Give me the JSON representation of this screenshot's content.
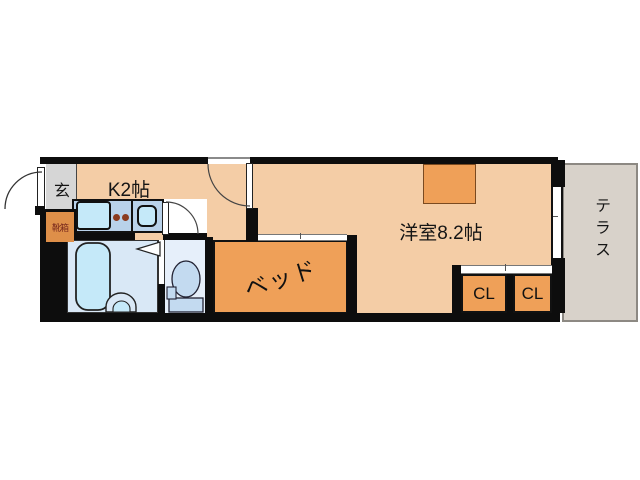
{
  "plan": {
    "labels": {
      "entrance": "玄",
      "shoe_box": "靴箱",
      "kitchen": "K2帖",
      "western_room": "洋室8.2帖",
      "bed": "ベッド",
      "closet_left": "CL",
      "closet_right": "CL",
      "terrace": "テラス"
    },
    "colors": {
      "wall": "#0d0d0d",
      "floor_peach": "#f4cda6",
      "furniture_orange": "#efa058",
      "shoebox_orange": "#de8f49",
      "shoebox_text": "#78281c",
      "counter_blue": "#b9d2ea",
      "fixture_cyan": "#c5e9f9",
      "bathroom_blue": "#d9e8f6",
      "toilet_room_blue": "#e6effa",
      "toilet_fixture_blue": "#c3daf0",
      "entrance_gray": "#d6d6d6",
      "terrace_gray": "#d8d2ca",
      "burner_dot": "#8b3a1e"
    }
  }
}
